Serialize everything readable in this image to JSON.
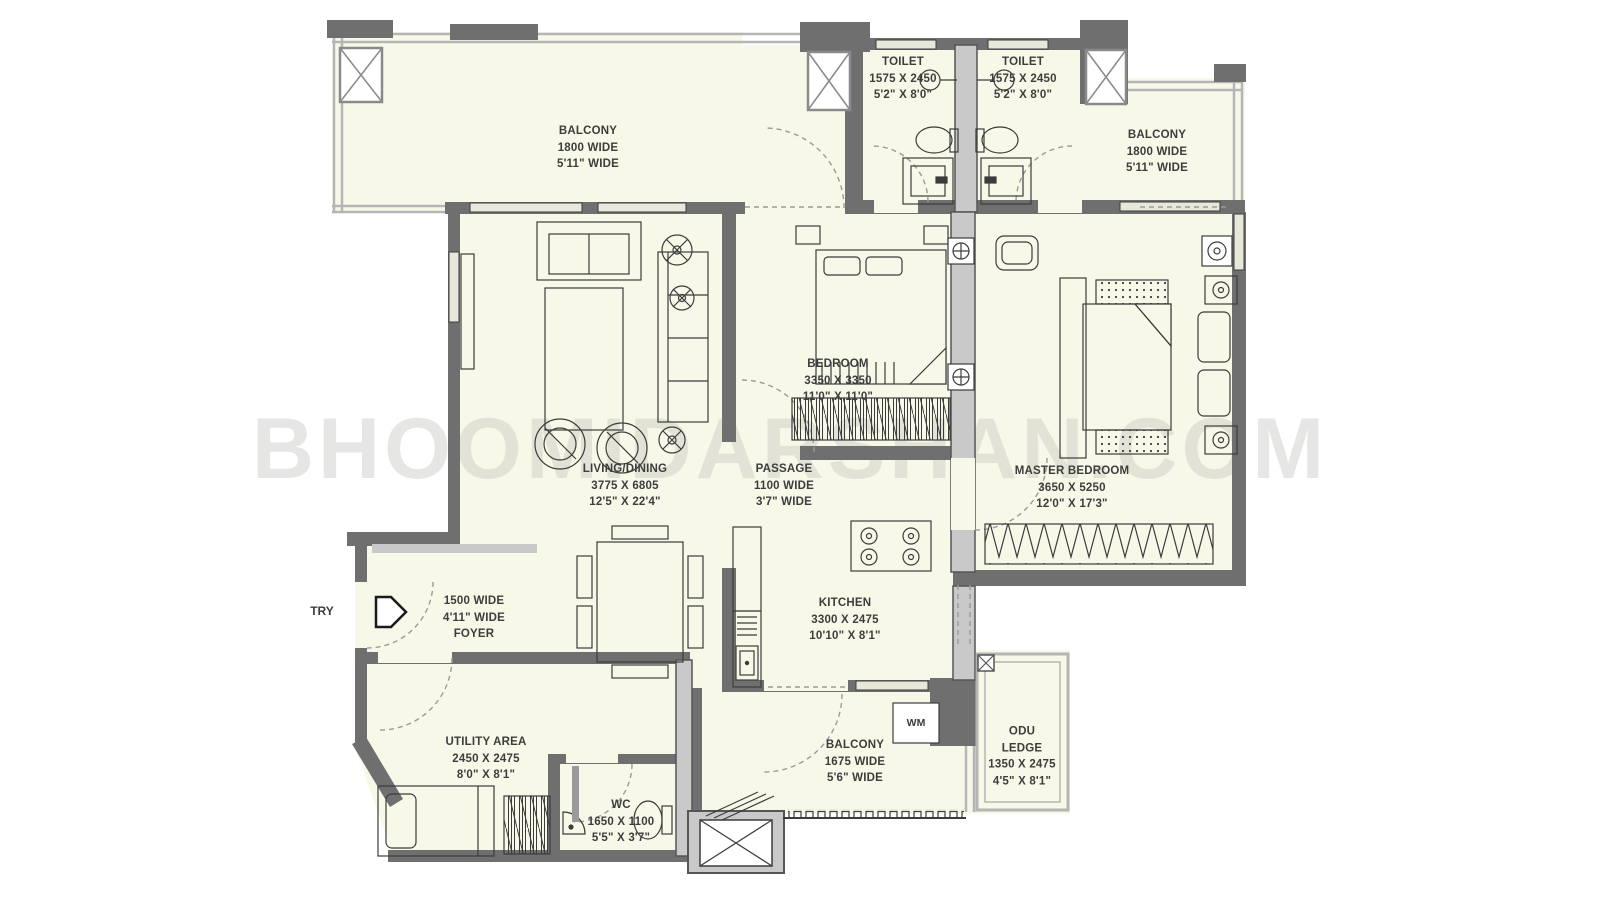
{
  "watermark": "BHOOMIDARSHAN.COM",
  "labels": {
    "entry": "TRY",
    "washing_machine": "WM"
  },
  "colors": {
    "room_fill": "#F8F8E9",
    "wall_dark": "#6F6F6F",
    "wall_light": "#C9C9C9",
    "line": "#3C3C3C",
    "watermark_gray": "#C6C6C0"
  },
  "rooms": {
    "balcony_tl": {
      "name": "BALCONY",
      "dim1": "1800 WIDE",
      "dim2": "5'11\" WIDE"
    },
    "toilet_left": {
      "name": "TOILET",
      "dim1": "1575 X 2450",
      "dim2": "5'2\" X 8'0\""
    },
    "toilet_right": {
      "name": "TOILET",
      "dim1": "1575 X 2450",
      "dim2": "5'2\" X 8'0\""
    },
    "balcony_tr": {
      "name": "BALCONY",
      "dim1": "1800 WIDE",
      "dim2": "5'11\" WIDE"
    },
    "bedroom": {
      "name": "BEDROOM",
      "dim1": "3350 X 3350",
      "dim2": "11'0\" X 11'0\""
    },
    "living_dining": {
      "name": "LIVING/DINING",
      "dim1": "3775 X 6805",
      "dim2": "12'5\" X 22'4\""
    },
    "passage": {
      "name": "PASSAGE",
      "dim1": "1100 WIDE",
      "dim2": "3'7\" WIDE"
    },
    "master_bedroom": {
      "name": "MASTER BEDROOM",
      "dim1": "3650 X 5250",
      "dim2": "12'0\" X 17'3\""
    },
    "kitchen": {
      "name": "KITCHEN",
      "dim1": "3300 X 2475",
      "dim2": "10'10\" X 8'1\""
    },
    "foyer": {
      "name": "FOYER",
      "dim1": "1500 WIDE",
      "dim2": "4'11\" WIDE"
    },
    "utility": {
      "name": "UTILITY AREA",
      "dim1": "2450 X 2475",
      "dim2": "8'0\" X 8'1\""
    },
    "wc": {
      "name": "WC",
      "dim1": "1650 X 1100",
      "dim2": "5'5\" X 3'7\""
    },
    "balcony_bottom": {
      "name": "BALCONY",
      "dim1": "1675 WIDE",
      "dim2": "5'6\" WIDE"
    },
    "odu_ledge": {
      "name": "ODU",
      "name2": "LEDGE",
      "dim1": "1350 X 2475",
      "dim2": "4'5\" X 8'1\""
    }
  }
}
